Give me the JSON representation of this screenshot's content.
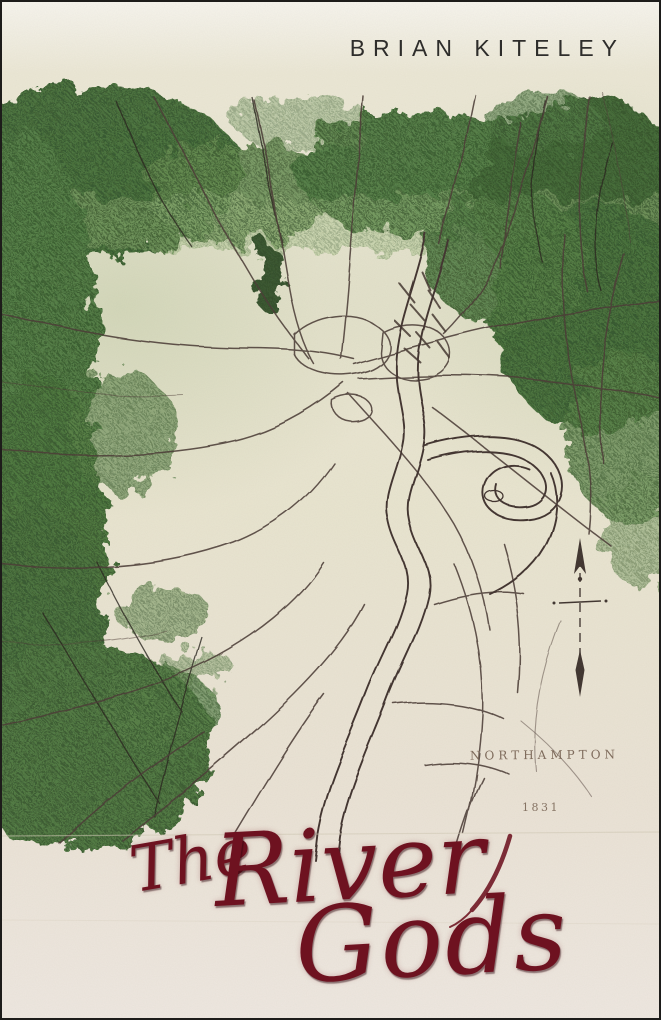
{
  "book_cover": {
    "author": "BRIAN KITELEY",
    "title": {
      "the": "The",
      "river": "River",
      "gods": "Gods"
    },
    "map": {
      "place_label": "NORTHAMPTON",
      "year_label": "1831"
    },
    "icons": {
      "compass": "north-arrow-icon"
    },
    "colors": {
      "title_red": "#6e1220",
      "author_text": "#2e2d2b",
      "foliage_green": "#47763a",
      "paper_cream": "#ece7d4",
      "map_ink_sepia": "#4a3b36"
    }
  }
}
